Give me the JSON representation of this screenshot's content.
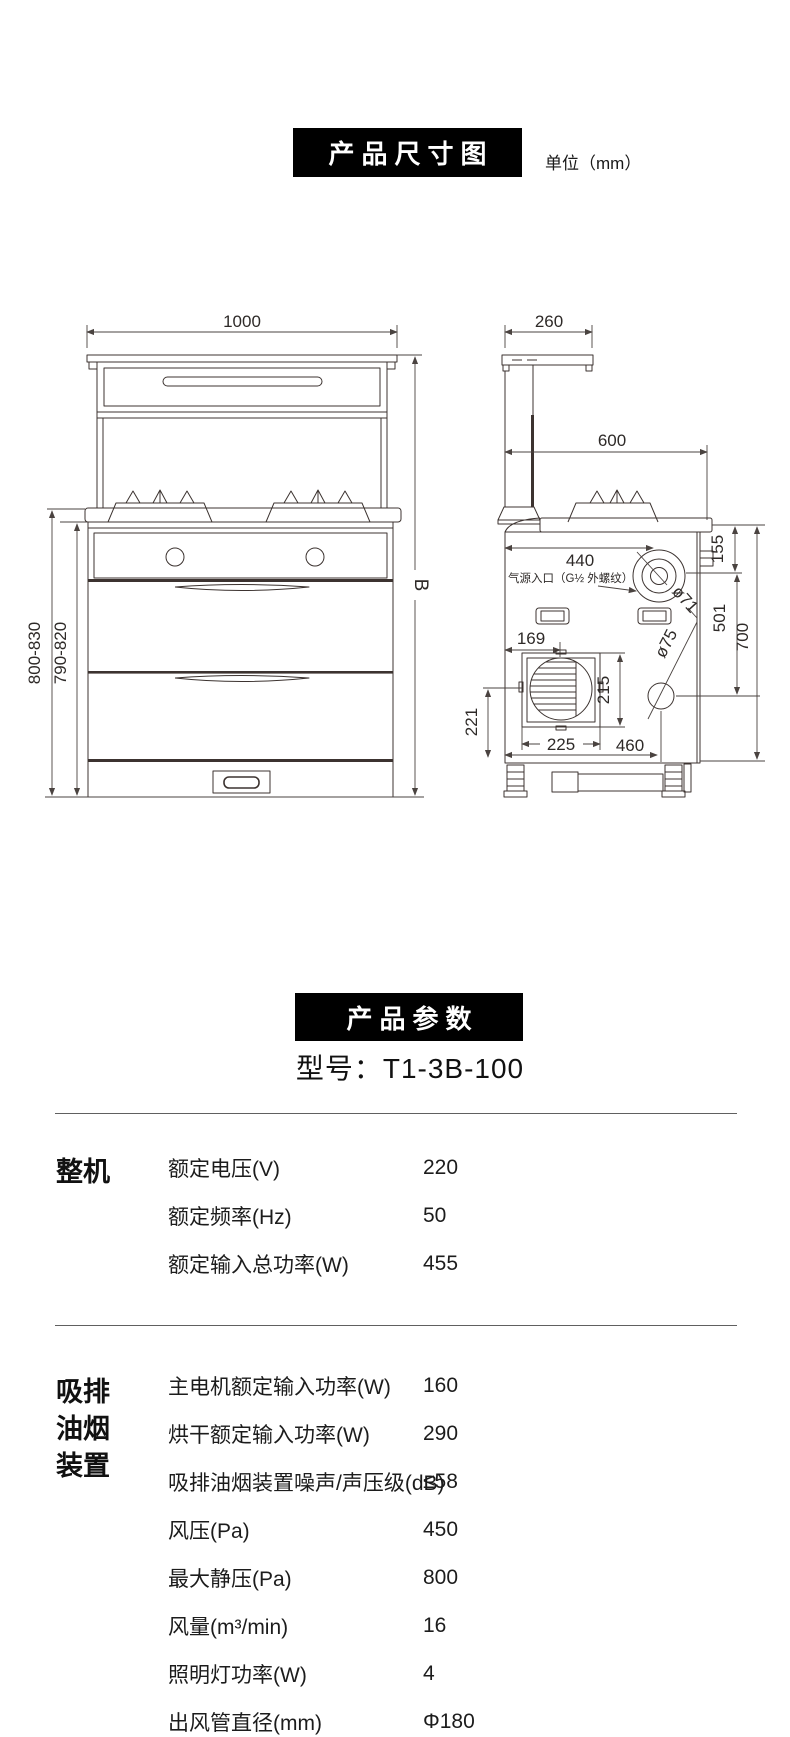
{
  "size_section": {
    "title": "产品尺寸图",
    "unit": "单位（mm）",
    "front": {
      "width": "1000",
      "h_outer": "800-830",
      "h_inner": "790-820",
      "h_right": "B"
    },
    "side": {
      "hood_depth": "260",
      "depth": "600",
      "inlet_x": "440",
      "gas_inlet": "气源入口（G½ 外螺纹）",
      "inlet_d": "ø71",
      "d155": "155",
      "d501": "501",
      "d700": "700",
      "d169": "169",
      "d215": "215",
      "outlet_d": "ø75",
      "d221": "221",
      "d225": "225",
      "d460": "460"
    }
  },
  "params_section": {
    "title": "产品参数",
    "model": "型号：T1-3B-100",
    "groups": [
      {
        "category": "整机",
        "rows": [
          {
            "label": "额定电压(V)",
            "value": "220"
          },
          {
            "label": "额定频率(Hz)",
            "value": "50"
          },
          {
            "label": "额定输入总功率(W)",
            "value": "455"
          }
        ]
      },
      {
        "category": "吸排油烟装置",
        "rows": [
          {
            "label": "主电机额定输入功率(W)",
            "value": "160"
          },
          {
            "label": "烘干额定输入功率(W)",
            "value": "290"
          },
          {
            "label": "吸排油烟装置噪声/声压级(dB)",
            "value": "≤58"
          },
          {
            "label": "风压(Pa)",
            "value": "450"
          },
          {
            "label": "最大静压(Pa)",
            "value": "800"
          },
          {
            "label": "风量(m³/min)",
            "value": "16"
          },
          {
            "label": "照明灯功率(W)",
            "value": "4"
          },
          {
            "label": "出风管直径(mm)",
            "value": "Φ180"
          }
        ]
      }
    ]
  }
}
